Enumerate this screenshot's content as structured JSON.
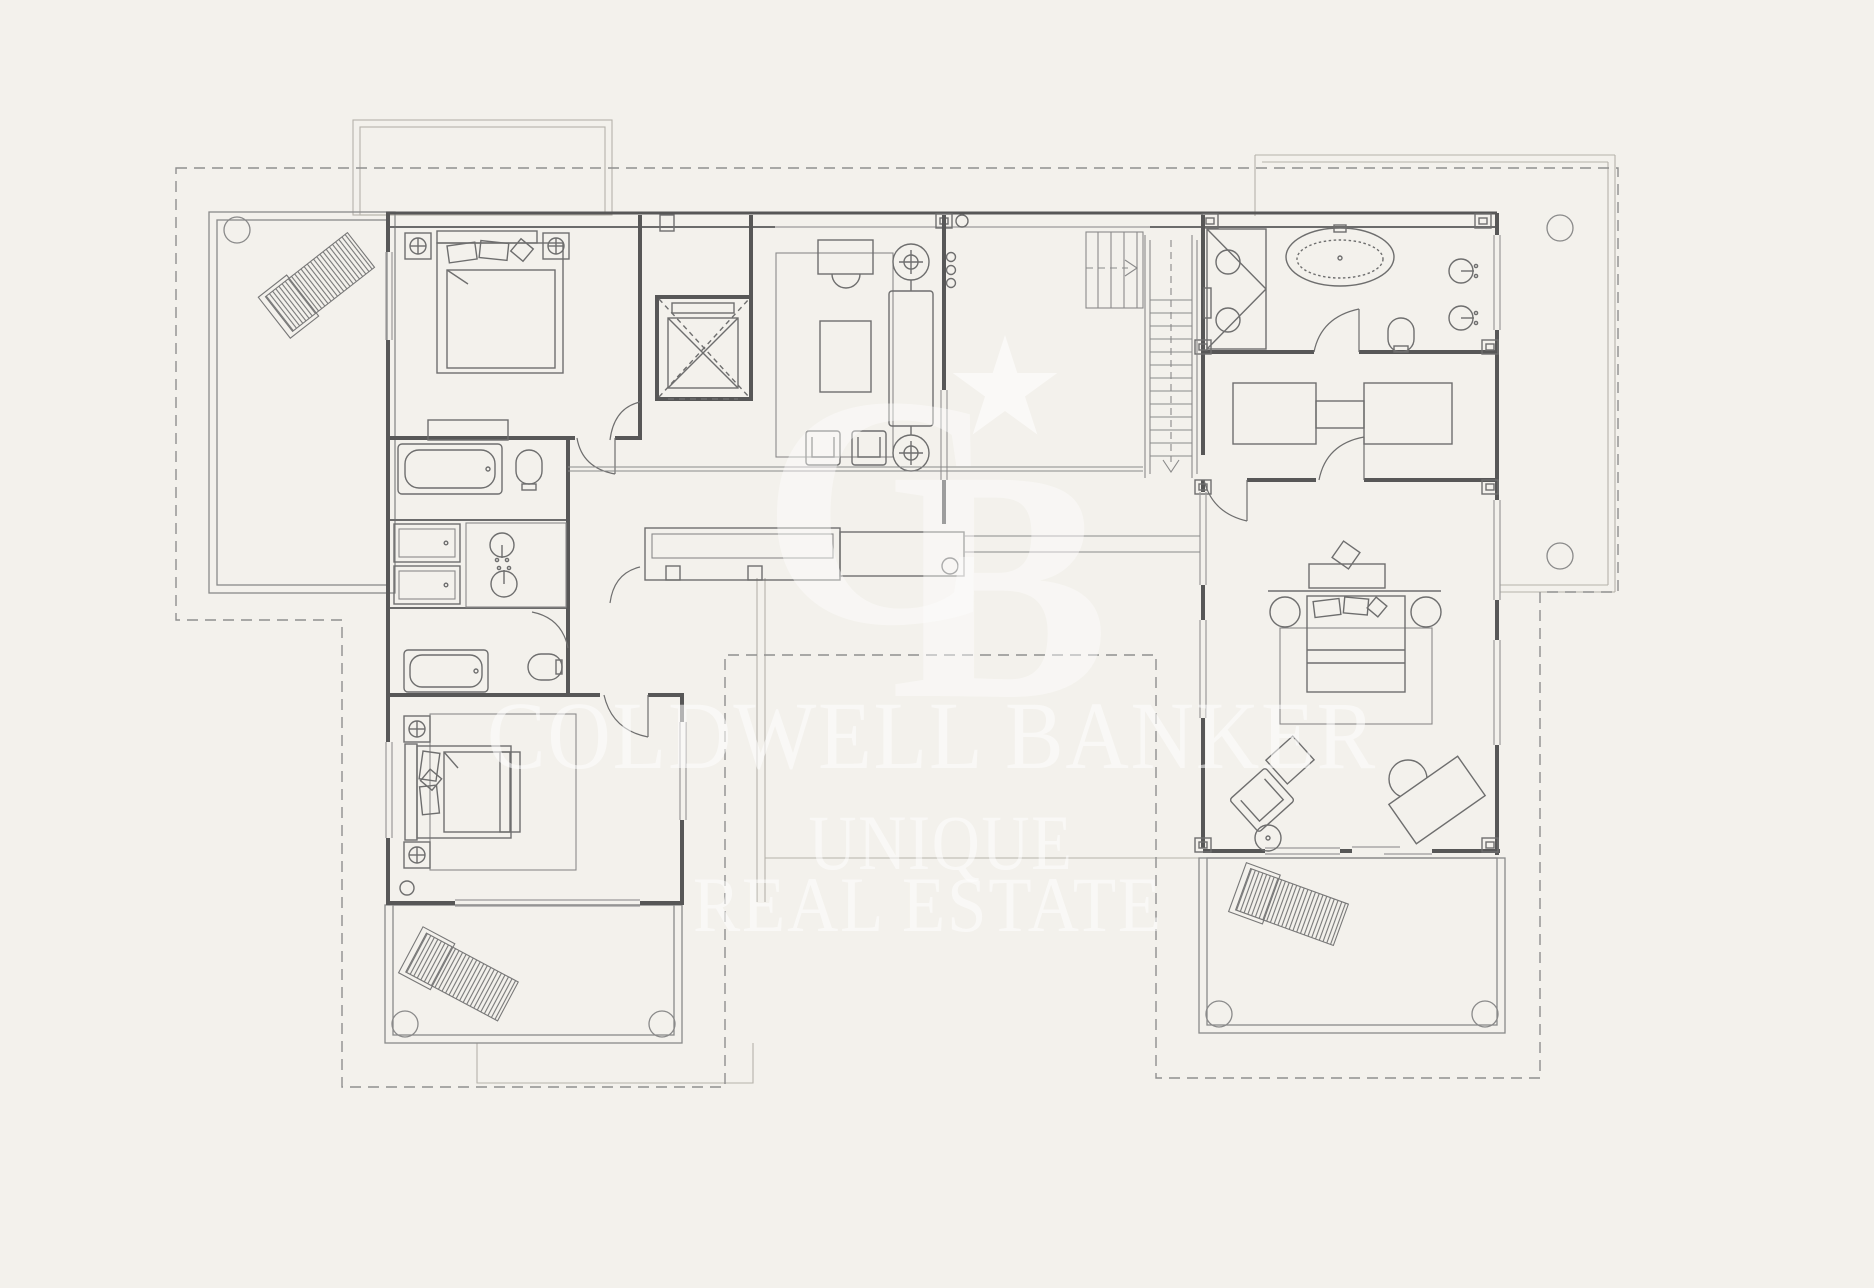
{
  "figure": {
    "kind": "architectural-floor-plan",
    "floor": "upper-floor-with-terraces"
  },
  "watermark": {
    "line1": "COLDWELL BANKER",
    "line2": "UNIQUE",
    "line3": "REAL ESTATE",
    "monogram_c": "C",
    "monogram_b": "B",
    "star_icon": "star-icon",
    "color": "#ffffff"
  },
  "colors": {
    "background": "#f3f1ec",
    "walls": "#575757",
    "furniture_lines": "#6e6e6e",
    "light_lines": "#9a9a9a",
    "faint_outline": "#b5b2aa",
    "roof_dashed_outline": "#8f8f8f",
    "lounger_hatch": "#777777"
  },
  "symbols": [
    "sun-lounger-icon",
    "double-bed-icon",
    "single-bed-icon",
    "bathtub-icon",
    "freestanding-bathtub-icon",
    "shower-icon",
    "washbasin-icon",
    "toilet-icon",
    "wardrobe-icon",
    "staircase-icon",
    "elevator-icon",
    "sofa-icon",
    "armchair-icon",
    "coffee-table-icon",
    "dining-table-icon",
    "desk-icon",
    "ceiling-speaker-icon",
    "rug-icon",
    "corner-column-icon"
  ]
}
